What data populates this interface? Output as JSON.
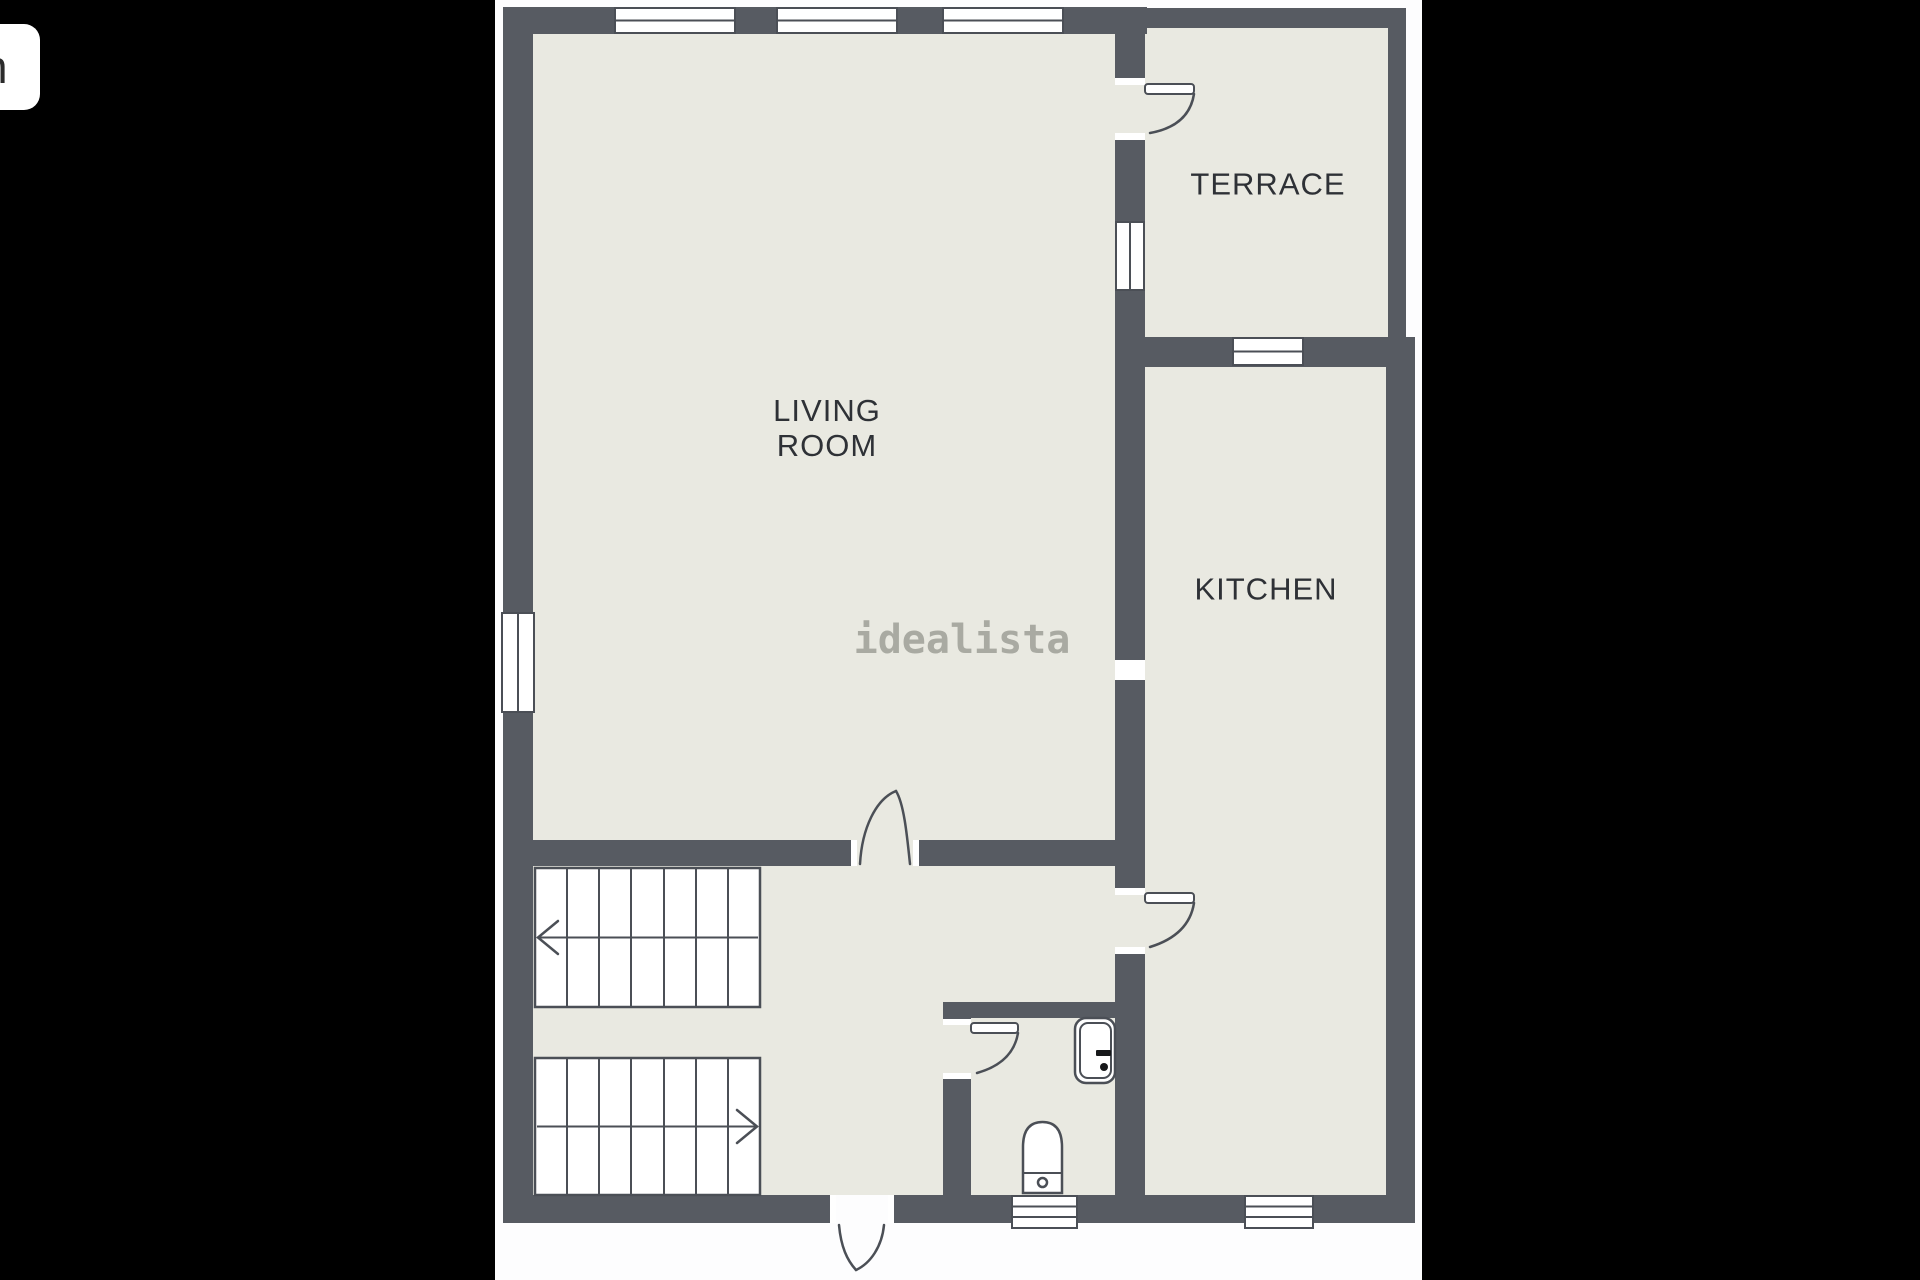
{
  "colors": {
    "letterbox": "#000000",
    "canvas": "#fdfdfe",
    "wall": "#575b62",
    "room-fill": "#e9e9e1",
    "outline": "#4b4f56",
    "label-text": "#2e3136",
    "watermark-color": "#a9aaa2",
    "badge-bg": "#ffffff",
    "badge-text": "#2b2b2b"
  },
  "viewer": {
    "badge_fragment": "n"
  },
  "floorplan": {
    "watermark": "idealista",
    "rooms": {
      "living_room": {
        "line1": "LIVING",
        "line2": "ROOM"
      },
      "terrace": {
        "label": "TERRACE"
      },
      "kitchen": {
        "label": "KITCHEN"
      }
    },
    "features": {
      "staircase_flights": 2,
      "doors": [
        "entrance",
        "living-room",
        "kitchen",
        "terrace",
        "bathroom"
      ],
      "windows": 8,
      "fixtures": [
        "sink",
        "toilet"
      ]
    }
  }
}
